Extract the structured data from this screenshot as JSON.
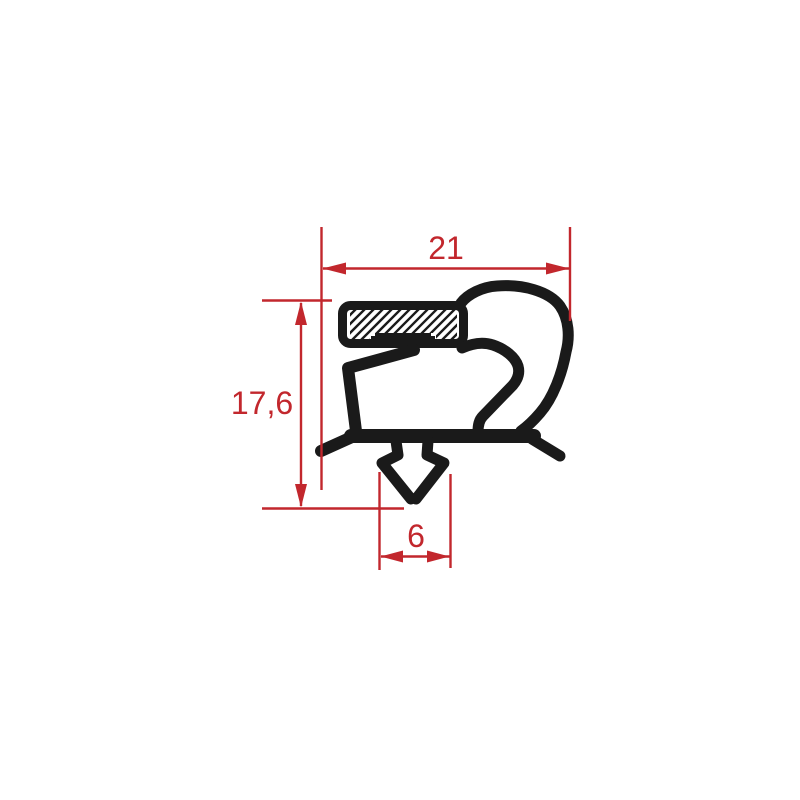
{
  "drawing": {
    "title": "gasket-profile-cross-section",
    "background": "#ffffff",
    "colors": {
      "profile": "#1a1a1a",
      "dimension": "#c2272d",
      "pocket_fill": "#ffffff"
    },
    "dimensions": {
      "width": {
        "value": "21"
      },
      "height": {
        "value": "17,6"
      },
      "dart_width": {
        "value": "6"
      }
    }
  }
}
